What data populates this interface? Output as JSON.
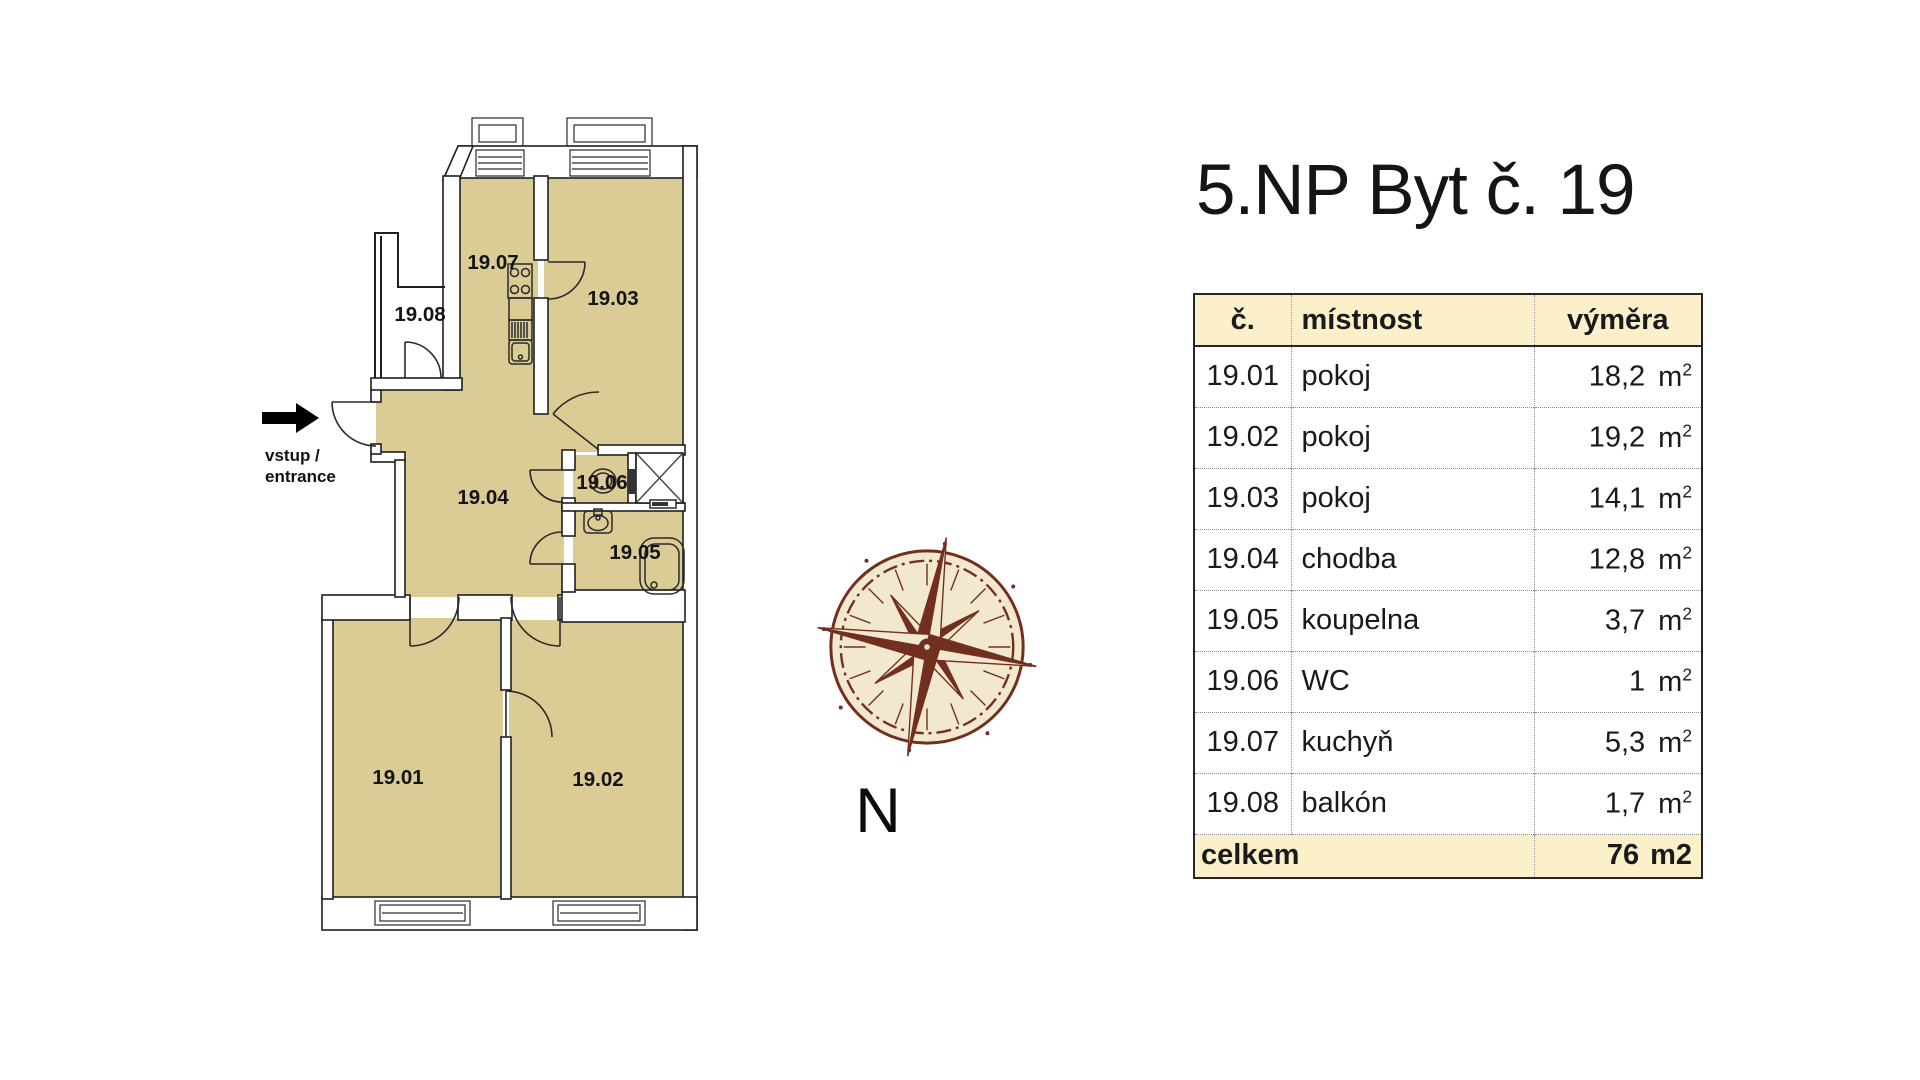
{
  "title": "5.NP Byt č. 19",
  "plan": {
    "entrance": {
      "line1": "vstup /",
      "line2": "entrance"
    },
    "labels": {
      "r1901": "19.01",
      "r1902": "19.02",
      "r1903": "19.03",
      "r1904": "19.04",
      "r1905": "19.05",
      "r1906": "19.06",
      "r1907": "19.07",
      "r1908": "19.08"
    }
  },
  "compass": {
    "north_label": "N"
  },
  "table": {
    "headers": {
      "num": "č.",
      "room": "místnost",
      "area": "výměra"
    },
    "unit": {
      "base": "m",
      "sup": "2"
    },
    "rows": [
      {
        "num": "19.01",
        "room": "pokoj",
        "area": "18,2"
      },
      {
        "num": "19.02",
        "room": "pokoj",
        "area": "19,2"
      },
      {
        "num": "19.03",
        "room": "pokoj",
        "area": "14,1"
      },
      {
        "num": "19.04",
        "room": "chodba",
        "area": "12,8"
      },
      {
        "num": "19.05",
        "room": "koupelna",
        "area": "3,7"
      },
      {
        "num": "19.06",
        "room": "WC",
        "area": "1"
      },
      {
        "num": "19.07",
        "room": "kuchyň",
        "area": "5,3"
      },
      {
        "num": "19.08",
        "room": "balkón",
        "area": "1,7"
      }
    ],
    "footer": {
      "label": "celkem",
      "value": "76",
      "unit": "m2"
    }
  },
  "colors": {
    "room_fill": "#dbcb95",
    "line": "#1f1f1f",
    "table_header_bg": "#fbf0ca",
    "table_border": "#262626",
    "table_dot": "#8c8c8c",
    "compass_brown": "#722f1f",
    "compass_cream": "#f2e8cf"
  }
}
